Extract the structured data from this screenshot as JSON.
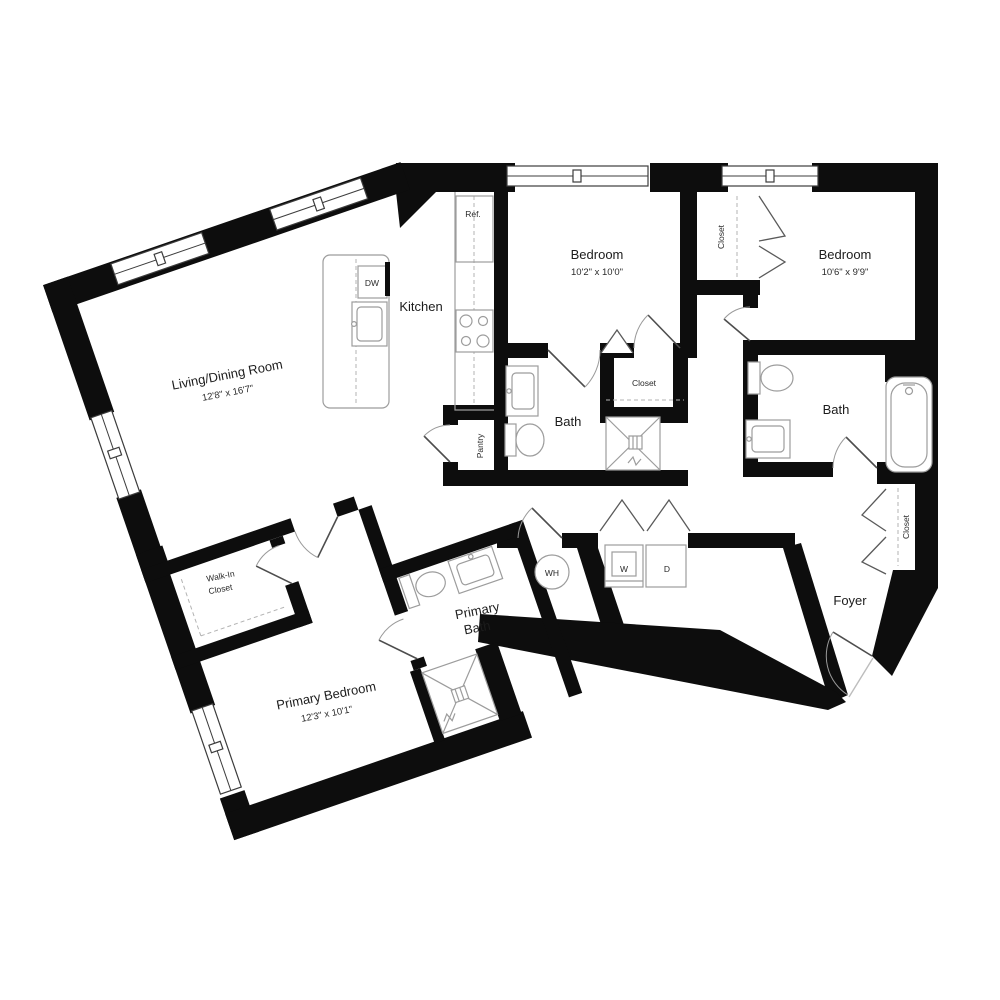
{
  "title": "Apartment floor plan",
  "colors": {
    "wall": "#0d0d0d",
    "fixture_stroke": "#9c9c9c",
    "text": "#1c1c1c",
    "background": "#ffffff"
  },
  "rooms": {
    "living_dining": {
      "name": "Living/Dining Room",
      "dims": "12'8\" x 16'7\""
    },
    "kitchen": {
      "name": "Kitchen"
    },
    "bedroom_1": {
      "name": "Bedroom",
      "dims": "10'2\" x 10'0\""
    },
    "bedroom_2": {
      "name": "Bedroom",
      "dims": "10'6\" x 9'9\""
    },
    "bath_1": {
      "name": "Bath"
    },
    "bath_2": {
      "name": "Bath"
    },
    "primary_bath": {
      "line1": "Primary",
      "line2": "Bath"
    },
    "primary_bedroom": {
      "name": "Primary Bedroom",
      "dims": "12'3\" x 10'1\""
    },
    "walk_in_closet": {
      "line1": "Walk-In",
      "line2": "Closet"
    },
    "foyer": {
      "name": "Foyer"
    },
    "pantry": {
      "name": "Pantry"
    }
  },
  "closets": {
    "bedroom_hall": "Closet",
    "bedroom_1_closet": "Closet",
    "foyer_closet": "Closet"
  },
  "appliances": {
    "dishwasher": "DW",
    "refrigerator": "Ref.",
    "water_heater": "WH",
    "washer": "W",
    "dryer": "D"
  }
}
